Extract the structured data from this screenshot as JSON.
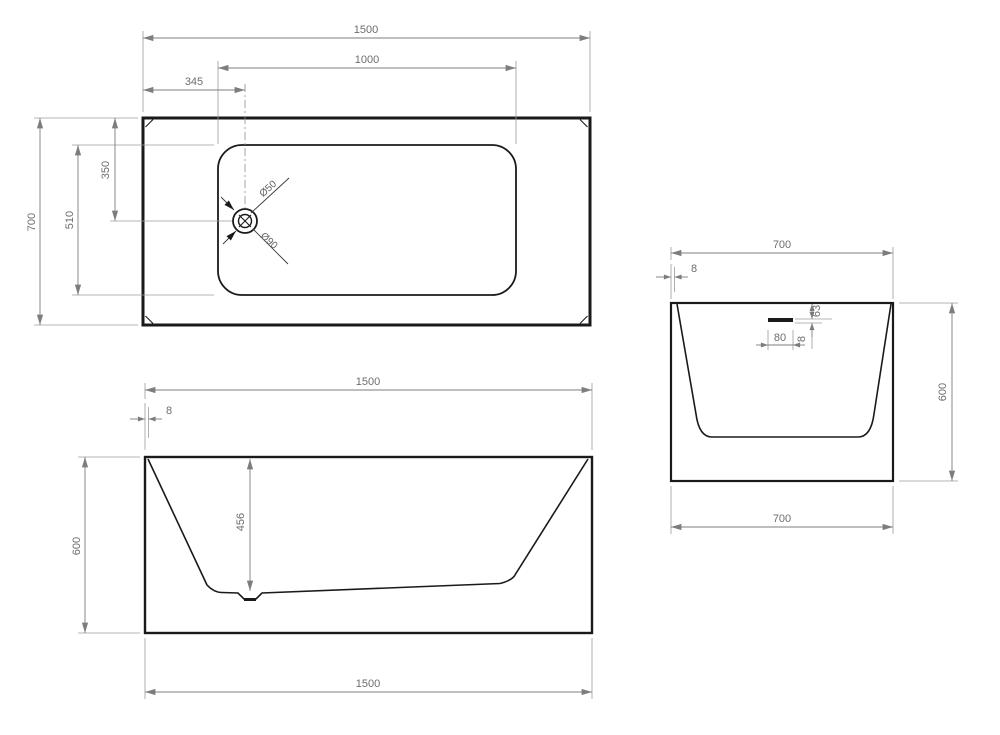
{
  "views": {
    "top": {
      "length": "1500",
      "basin_length": "1000",
      "drain_offset_left": "345",
      "width": "700",
      "basin_width": "510",
      "drain_offset_top": "350",
      "drain_diameter_inner": "Ø50",
      "drain_diameter_outer": "Ø90"
    },
    "front": {
      "length_top": "1500",
      "rim_thickness": "8",
      "height": "600",
      "inner_depth": "456",
      "length_bottom": "1500"
    },
    "side": {
      "width_top": "700",
      "rim_thickness": "8",
      "overflow_offset_top": "63",
      "overflow_width": "80",
      "overflow_height": "8",
      "height": "600",
      "width_bottom": "700"
    }
  },
  "colors": {
    "object_line": "#1a1a1a",
    "dimension_line": "#7d7d7d",
    "text": "#6d6d6d",
    "background": "#ffffff"
  }
}
